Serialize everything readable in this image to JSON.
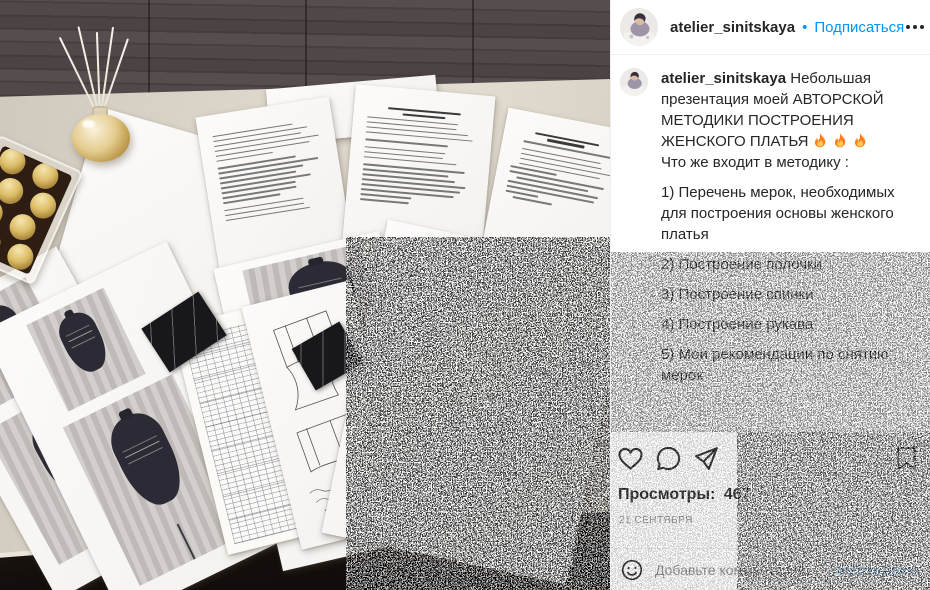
{
  "header": {
    "username": "atelier_sinitskaya",
    "dot": "•",
    "follow_label": "Подписаться",
    "more_label": "Ещё"
  },
  "caption": {
    "username": "atelier_sinitskaya",
    "intro": "Небольшая презентация моей АВТОРСКОЙ МЕТОДИКИ ПОСТРОЕНИЯ ЖЕНСКОГО ПЛАТЬЯ",
    "fire_emoji": "🔥🔥🔥",
    "paragraphs": [
      "Что же входит в методику :",
      "1) Перечень мерок, необходимых для построения основы женского платья",
      "2) Построение полочки",
      "3) Построение спинки",
      "4) Построение рукава",
      "5) Мои рекомендации по снятию мерок"
    ]
  },
  "engagement": {
    "views_label": "Просмотры:",
    "views_count": "467",
    "date": "21 СЕНТЯБРЯ"
  },
  "comment_box": {
    "placeholder": "Добавьте комментарий...",
    "submit_label": "Опубликовать"
  },
  "photo": {
    "labels": {
      "schema_a": "схема A",
      "schema_b": "СХЕМА B"
    }
  },
  "colors": {
    "accent": "#0095f6",
    "text": "#262626",
    "muted": "#8e8e8e",
    "divider": "#efefef",
    "table_surface": "#d9d3c8",
    "wood": "#4e4546",
    "floor": "#14100c"
  }
}
